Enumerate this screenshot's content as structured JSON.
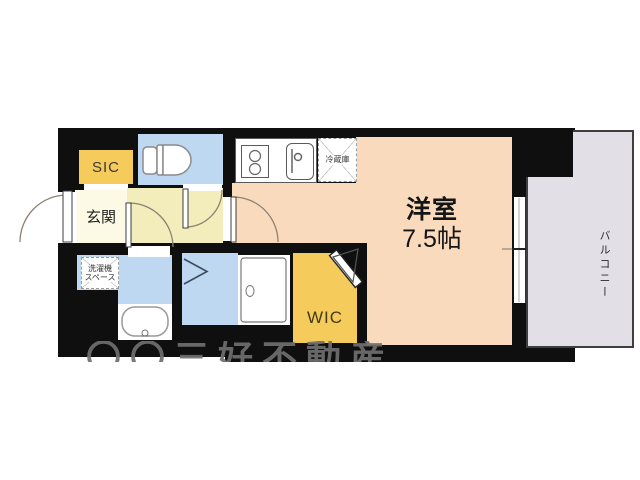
{
  "title": "apartment-floor-plan",
  "labels": {
    "entrance": "玄関",
    "shoe_closet": "SIC",
    "walk_in_closet": "WIC",
    "main_room": "洋室",
    "main_room_size": "7.5帖",
    "balcony": "バルコニー",
    "refrigerator": "冷蔵庫",
    "laundry_line1": "洗濯機",
    "laundry_line2": "スペース"
  },
  "watermark": {
    "partial_text": "〇〇三好不動産"
  },
  "colors": {
    "wall": "#0f0f0f",
    "peach": "#f9dabc",
    "blue": "#bed8f2",
    "accent-yellow": "#f5cb5b",
    "cream": "#fcfae4",
    "corridor": "#f3edbc",
    "balcony": "#e2e0e6"
  }
}
